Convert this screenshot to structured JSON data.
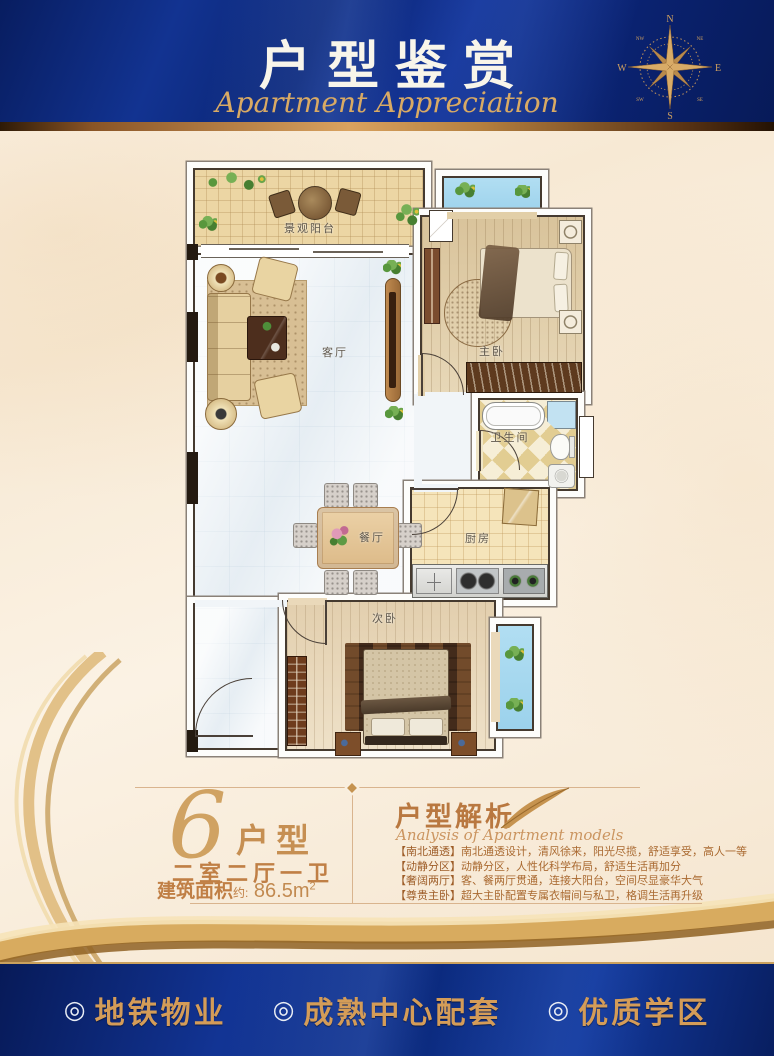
{
  "header": {
    "title": "户型鉴赏",
    "subtitle": "Apartment Appreciation",
    "compass": {
      "n": "N",
      "s": "S",
      "e": "E",
      "w": "W",
      "ne": "NE",
      "nw": "NW",
      "se": "SE",
      "sw": "SW"
    }
  },
  "floorplan": {
    "rooms": [
      {
        "id": "view-balcony",
        "label": "景观阳台"
      },
      {
        "id": "living-room",
        "label": "客厅"
      },
      {
        "id": "master-bedroom",
        "label": "主卧"
      },
      {
        "id": "bathroom",
        "label": "卫生间"
      },
      {
        "id": "kitchen",
        "label": "厨房"
      },
      {
        "id": "dining-room",
        "label": "餐厅"
      },
      {
        "id": "second-bedroom",
        "label": "次卧"
      }
    ]
  },
  "unit": {
    "number": "6",
    "suffix": "户型",
    "layout": "二室二厅一卫",
    "area_label": "建筑面积",
    "area_approx": "约:",
    "area_value": " 86.5m",
    "area_sup": "2"
  },
  "analysis": {
    "title": "户型解析",
    "subtitle": "Analysis of Apartment models",
    "points": [
      {
        "tag": "【南北通透】",
        "text": "南北通透设计，清风徐来，阳光尽揽，舒适享受，高人一等"
      },
      {
        "tag": "【动静分区】",
        "text": "动静分区，人性化科学布局，舒适生活再加分"
      },
      {
        "tag": "【奢阔两厅】",
        "text": "客、餐两厅贯通，连接大阳台，空间尽显豪华大气"
      },
      {
        "tag": "【尊贵主卧】",
        "text": "超大主卧配置专属衣帽间与私卫，格调生活再升级"
      }
    ]
  },
  "footer": {
    "items": [
      {
        "bullet": "◎",
        "label": "地铁物业"
      },
      {
        "bullet": "◎",
        "label": "成熟中心配套"
      },
      {
        "bullet": "◎",
        "label": "优质学区"
      }
    ]
  },
  "colors": {
    "banner_blue": "#0d2b80",
    "gold": "#cf9c5e",
    "bronze": "#b5803f",
    "cream": "#f9efe0",
    "wall": "#453a2f",
    "water_blue": "#a6d9f0",
    "wood": "#e2cfa8",
    "marble": "#f1f5f8"
  }
}
